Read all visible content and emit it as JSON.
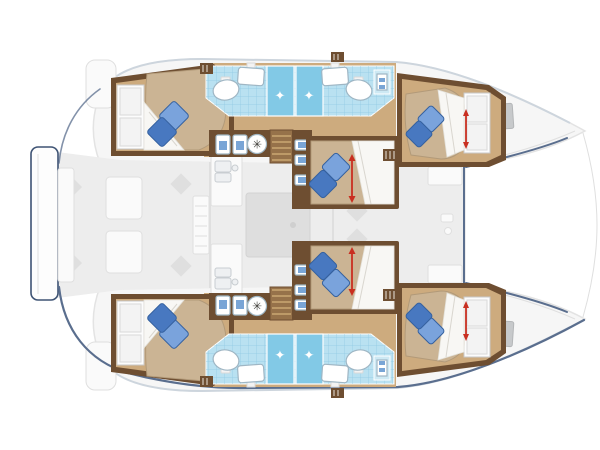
{
  "meta": {
    "diagram_type": "yacht-floor-plan",
    "vessel_type": "catamaran",
    "view": "top-down",
    "bow_direction": "right"
  },
  "counts": {
    "hulls": 2,
    "cabins": 6,
    "double_beds": 6,
    "pillows_per_bed": 2,
    "bathrooms": 4,
    "shower_stalls": 4,
    "sinks": 4,
    "toilets": 4
  },
  "icons": {
    "sparkle": "✦",
    "fan": "✳"
  },
  "palette": {
    "bg": "#ffffff",
    "hull_fill": "#f6f6f6",
    "hull_stroke": "#e3e3e3",
    "hull_edge": "#cdd5dd",
    "deck": "#ededed",
    "deck_furniture": "#fafafa",
    "deck_line": "#dfdfdf",
    "deck_diamond": "#dfdfdf",
    "hatch": "#c7c9cb",
    "rug": "#dedede",
    "navy": "#5a6e8e",
    "navy_dark": "#3e5374",
    "wood_floor": "#cdab7e",
    "wood_dark": "#6e4e31",
    "wood_mid": "#96724a",
    "wood_tread": "#caa873",
    "mattress": "#cbb494",
    "mattress_edge": "#b29a79",
    "duvet": "#f8f7f4",
    "duvet_line": "#d9d6cf",
    "pillow_light": "#7aa3dc",
    "pillow_dark": "#4878c0",
    "pillow_edge": "#35619f",
    "tile": "#b9e1f1",
    "tile_line": "#8fc9e2",
    "shower": "#82c9e6",
    "fixture": "#ffffff",
    "fixture_stroke": "#9fb6c4",
    "fixture_blue": "#79a5d6",
    "red": "#c92f20"
  }
}
